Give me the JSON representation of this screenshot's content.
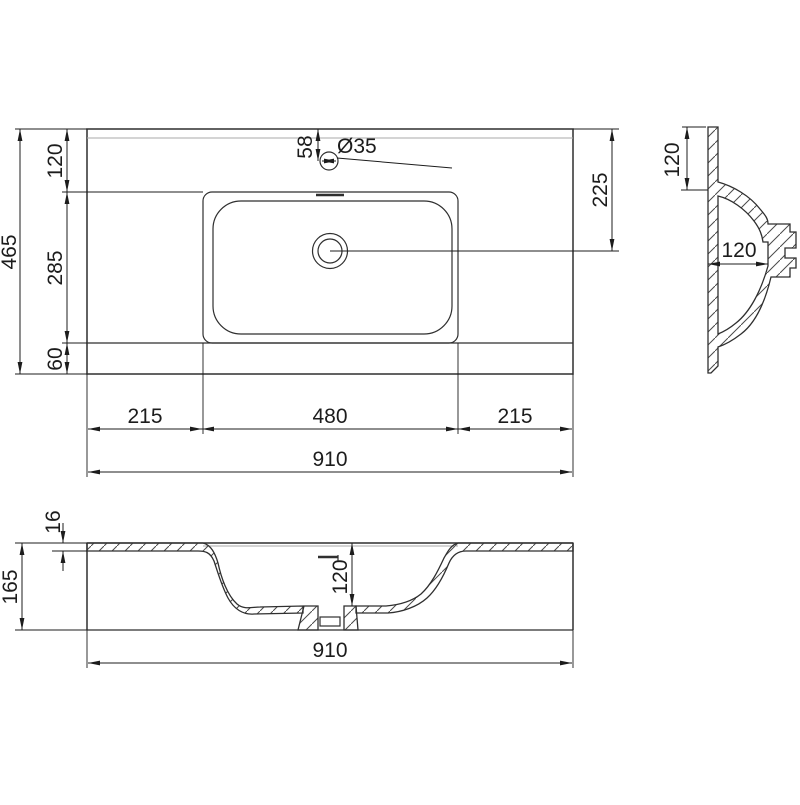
{
  "plan": {
    "overall_width": "910",
    "overall_depth": "465",
    "back_edge_to_basin": "120",
    "basin_cutout_depth": "285",
    "basin_to_front_edge": "60",
    "left_edge_to_basin": "215",
    "basin_cutout_width": "480",
    "basin_to_right_edge": "215",
    "faucet_center_from_back": "58",
    "faucet_hole_diameter": "Ø35",
    "drain_center_from_back": "225"
  },
  "side": {
    "back_ledge_height": "120",
    "bowl_depth_horizontal": "120"
  },
  "front": {
    "top_thickness": "16",
    "overall_height": "165",
    "bowl_inner_depth": "120",
    "overall_width": "910"
  },
  "colors": {
    "line": "#2f2f2f",
    "dimension_line": "#1c1c1c",
    "secondary_line": "#a8a8a8",
    "background": "#ffffff"
  }
}
